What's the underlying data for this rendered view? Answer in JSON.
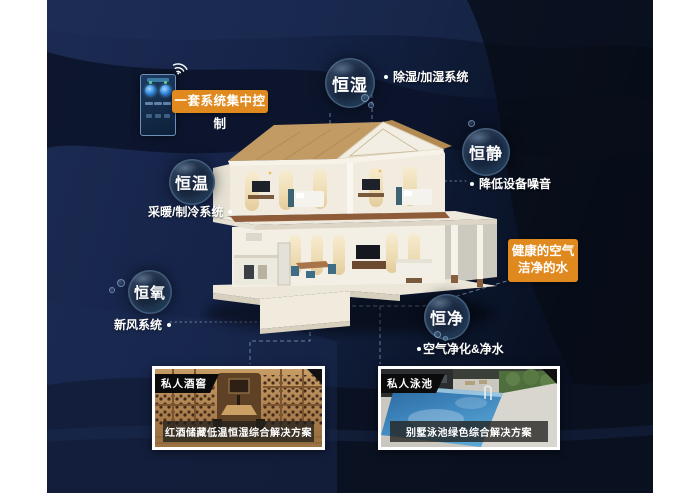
{
  "colors": {
    "accent_orange": "#E0891E",
    "panel_navy": "#13203E",
    "bubble_rim_blue": "#82AAD2",
    "label_white": "#FFFFFF"
  },
  "control": {
    "box_label": "一套系统集中控制"
  },
  "bubbles": [
    {
      "id": "heng-shi",
      "label": "恒湿",
      "note": "除湿/加湿系统"
    },
    {
      "id": "heng-jing",
      "label": "恒静",
      "note": "降低设备噪音"
    },
    {
      "id": "heng-wen",
      "label": "恒温",
      "note": "采暖/制冷系统"
    },
    {
      "id": "heng-yang",
      "label": "恒氧",
      "note": "新风系统"
    },
    {
      "id": "heng-jing-water",
      "label": "恒净",
      "note": "空气净化&净水"
    }
  ],
  "highlight": {
    "line1": "健康的空气",
    "line2": "洁净的水"
  },
  "photos": [
    {
      "tag": "私人酒窖",
      "caption": "红酒储藏低温恒湿综合解决方案"
    },
    {
      "tag": "私人泳池",
      "caption": "别墅泳池绿色综合解决方案"
    }
  ]
}
